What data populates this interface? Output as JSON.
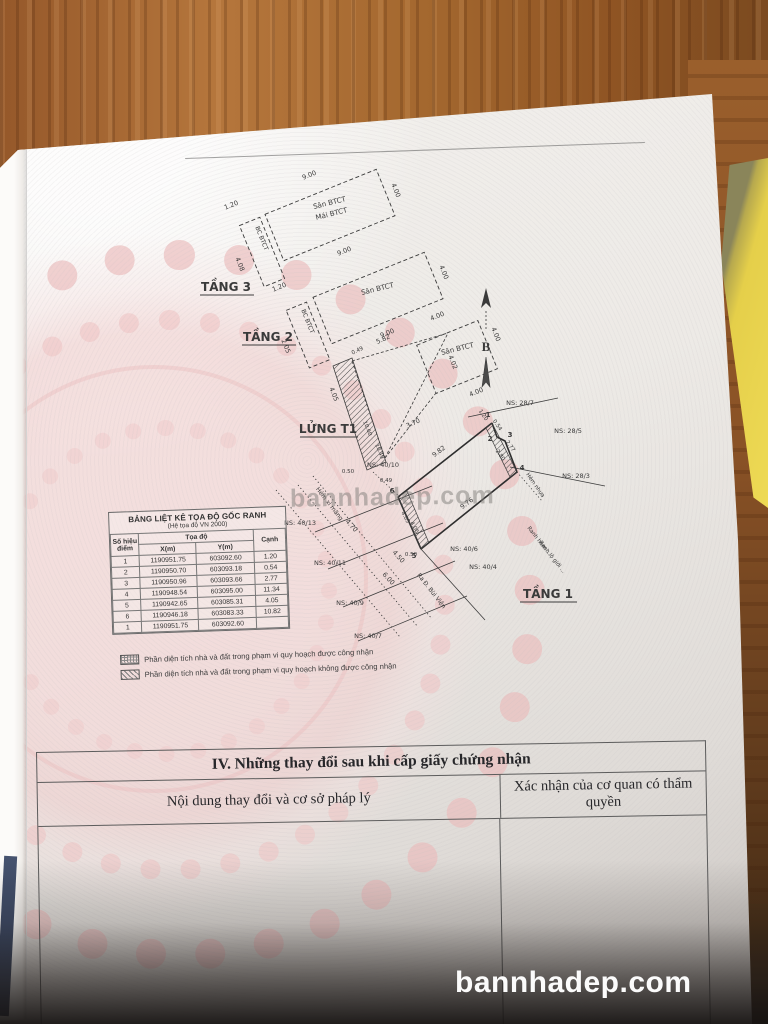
{
  "page": {
    "section3_title": "III. Sơ đồ thửa đất, nhà ở và tài sản khác gắn liền với đất",
    "section4": {
      "title": "IV. Những thay đổi sau khi cấp giấy chứng nhận",
      "col_left": "Nội dung thay đổi và cơ sở pháp lý",
      "col_right": "Xác nhận của cơ quan có thẩm quyền"
    }
  },
  "watermark": {
    "site": "bannhadep.com",
    "site_faint": "bannhadep.com"
  },
  "coord_table": {
    "title": "BẢNG LIỆT KÊ TỌA ĐỘ GỐC RANH",
    "subtitle": "(Hệ tọa độ VN 2000)",
    "headers": {
      "point": "Số hiệu điểm",
      "coords": "Tọa độ",
      "x": "X(m)",
      "y": "Y(m)",
      "edge": "Cạnh"
    },
    "rows": [
      [
        "1",
        "1190951.75",
        "603092.60",
        "1.20"
      ],
      [
        "2",
        "1190950.70",
        "603093.18",
        "0.54"
      ],
      [
        "3",
        "1190950.96",
        "603093.66",
        "2.77"
      ],
      [
        "4",
        "1190948.54",
        "603095.00",
        "11.34"
      ],
      [
        "5",
        "1190942.65",
        "603085.31",
        "4.05"
      ],
      [
        "6",
        "1190946.18",
        "603083.33",
        "10.82"
      ],
      [
        "1",
        "1190951.75",
        "603092.60",
        ""
      ]
    ]
  },
  "legend": [
    {
      "style": "crosshatch",
      "label": "Phần diện tích nhà và đất trong phạm vi quy hoạch được công nhận"
    },
    {
      "style": "diagonal",
      "label": "Phần diện tích nhà và đất trong phạm vi quy hoạch không được công nhận"
    }
  ],
  "drawing": {
    "colors": {
      "line": "#3a3a3a",
      "paper_pink": "#f3cfcf"
    },
    "texts": [
      {
        "t": "TẦNG 3",
        "x": 46,
        "y": 136,
        "s": 12,
        "b": 1,
        "n": "floor3-label"
      },
      {
        "t": "TẦNG 2",
        "x": 88,
        "y": 186,
        "s": 12,
        "b": 1,
        "n": "floor2-label"
      },
      {
        "t": "LỬNG T1",
        "x": 148,
        "y": 278,
        "s": 12,
        "b": 1,
        "n": "mezzanine-label"
      },
      {
        "t": "TẦNG 1",
        "x": 368,
        "y": 443,
        "s": 12,
        "b": 1,
        "n": "floor1-label"
      },
      {
        "t": "B",
        "x": 306,
        "y": 196,
        "s": 13,
        "b": 1,
        "f": "serif",
        "n": "north-letter"
      },
      {
        "t": "Sân BTCT",
        "x": 150,
        "y": 50,
        "r": -14,
        "s": 7,
        "n": "room-label"
      },
      {
        "t": "Mái BTCT",
        "x": 152,
        "y": 61,
        "r": -14,
        "s": 7,
        "n": "room-label"
      },
      {
        "t": "Sân BTCT",
        "x": 198,
        "y": 136,
        "r": -14,
        "s": 7,
        "n": "room-label"
      },
      {
        "t": "Sân BTCT",
        "x": 278,
        "y": 196,
        "r": -14,
        "s": 7,
        "n": "room-label"
      },
      {
        "t": "BC BTCT",
        "x": 80,
        "y": 84,
        "r": 68,
        "s": 6,
        "n": "room-label"
      },
      {
        "t": "BC BTCT",
        "x": 126,
        "y": 167,
        "r": 68,
        "s": 6,
        "n": "room-label"
      },
      {
        "t": "9.00",
        "x": 130,
        "y": 22,
        "r": -22
      },
      {
        "t": "4.00",
        "x": 214,
        "y": 36,
        "r": 68
      },
      {
        "t": "1.20",
        "x": 52,
        "y": 52,
        "r": -22
      },
      {
        "t": "4.08",
        "x": 58,
        "y": 110,
        "r": 68
      },
      {
        "t": "9.00",
        "x": 165,
        "y": 98,
        "r": -22
      },
      {
        "t": "4.00",
        "x": 262,
        "y": 118,
        "r": 68
      },
      {
        "t": "1.20",
        "x": 100,
        "y": 134,
        "r": -22
      },
      {
        "t": "2.05",
        "x": 104,
        "y": 192,
        "r": 68
      },
      {
        "t": "9.00",
        "x": 208,
        "y": 180,
        "r": -22
      },
      {
        "t": "4.00",
        "x": 258,
        "y": 163,
        "r": -22
      },
      {
        "t": "4.00",
        "x": 314,
        "y": 180,
        "r": 68
      },
      {
        "t": "4.02",
        "x": 271,
        "y": 208,
        "r": 68
      },
      {
        "t": "4.00",
        "x": 297,
        "y": 239,
        "r": -22
      },
      {
        "t": "5.82",
        "x": 204,
        "y": 186,
        "r": -25
      },
      {
        "t": "0.49",
        "x": 178,
        "y": 197,
        "r": -25,
        "s": 5.5
      },
      {
        "t": "3.70",
        "x": 234,
        "y": 270,
        "r": -25
      },
      {
        "t": "4.05",
        "x": 152,
        "y": 240,
        "r": 68
      },
      {
        "t": "10.60",
        "x": 186,
        "y": 274,
        "r": 68,
        "s": 5.5
      },
      {
        "t": "10.49",
        "x": 198,
        "y": 297,
        "r": 68,
        "s": 5.5
      },
      {
        "t": "0.50",
        "x": 168,
        "y": 318,
        "s": 5.5
      },
      {
        "t": "9.82",
        "x": 260,
        "y": 298,
        "r": -37
      },
      {
        "t": "9.76",
        "x": 288,
        "y": 350,
        "r": -37
      },
      {
        "t": "1.20",
        "x": 302,
        "y": 261,
        "r": 55,
        "s": 5.5
      },
      {
        "t": "0.54",
        "x": 316,
        "y": 271,
        "r": 55,
        "s": 5.5
      },
      {
        "t": "2.77",
        "x": 329,
        "y": 292,
        "r": 55,
        "s": 5.5
      },
      {
        "t": "2.80",
        "x": 319,
        "y": 301,
        "r": 55,
        "s": 5.5
      },
      {
        "t": "4.05",
        "x": 224,
        "y": 363,
        "r": 62,
        "s": 5.5
      },
      {
        "t": "4.06",
        "x": 233,
        "y": 373,
        "r": 62,
        "s": 5.5
      },
      {
        "t": "0.49",
        "x": 206,
        "y": 327,
        "s": 5.5
      },
      {
        "t": "0.50",
        "x": 231,
        "y": 401,
        "s": 5.5
      },
      {
        "t": "4.70",
        "x": 170,
        "y": 372,
        "r": 48
      },
      {
        "t": "4.50",
        "x": 217,
        "y": 403,
        "r": 48
      },
      {
        "t": "6.00",
        "x": 207,
        "y": 425,
        "r": 48
      },
      {
        "t": "NS: 28/7",
        "x": 340,
        "y": 250
      },
      {
        "t": "NS: 28/5",
        "x": 388,
        "y": 278
      },
      {
        "t": "NS: 28/3",
        "x": 396,
        "y": 323
      },
      {
        "t": "NS: 40/10",
        "x": 203,
        "y": 312
      },
      {
        "t": "NS: 40/13",
        "x": 120,
        "y": 370
      },
      {
        "t": "NS: 40/11",
        "x": 150,
        "y": 410
      },
      {
        "t": "NS: 40/9",
        "x": 170,
        "y": 450
      },
      {
        "t": "NS: 40/7",
        "x": 188,
        "y": 483
      },
      {
        "t": "NS: 40/6",
        "x": 284,
        "y": 396
      },
      {
        "t": "NS: 40/4",
        "x": 303,
        "y": 414
      },
      {
        "t": "Hẻm xi măng",
        "x": 148,
        "y": 350,
        "r": 52,
        "s": 6,
        "n": "street-label"
      },
      {
        "t": "Ra Đ. Bùi Viện",
        "x": 250,
        "y": 437,
        "r": 52,
        "s": 6,
        "n": "street-label"
      },
      {
        "t": "Ranh hẻm …",
        "x": 358,
        "y": 387,
        "r": 52,
        "s": 5.5,
        "n": "boundary-label"
      },
      {
        "t": "Ranh lộ giới …",
        "x": 371,
        "y": 403,
        "r": 52,
        "s": 5.5,
        "n": "boundary-label"
      },
      {
        "t": "Hẻm nhựa",
        "x": 354,
        "y": 331,
        "r": 55,
        "s": 5.5,
        "n": "street-label"
      },
      {
        "t": "1",
        "x": 308,
        "y": 262,
        "s": 7,
        "b": 1,
        "n": "point-number"
      },
      {
        "t": "2",
        "x": 310,
        "y": 286,
        "s": 7,
        "b": 1,
        "n": "point-number"
      },
      {
        "t": "3",
        "x": 330,
        "y": 282,
        "s": 7,
        "b": 1,
        "n": "point-number"
      },
      {
        "t": "4",
        "x": 342,
        "y": 315,
        "s": 7,
        "b": 1,
        "n": "point-number"
      },
      {
        "t": "5",
        "x": 234,
        "y": 403,
        "s": 7,
        "b": 1,
        "n": "point-number"
      },
      {
        "t": "6",
        "x": 212,
        "y": 338,
        "s": 7,
        "b": 1,
        "n": "point-number"
      }
    ]
  }
}
